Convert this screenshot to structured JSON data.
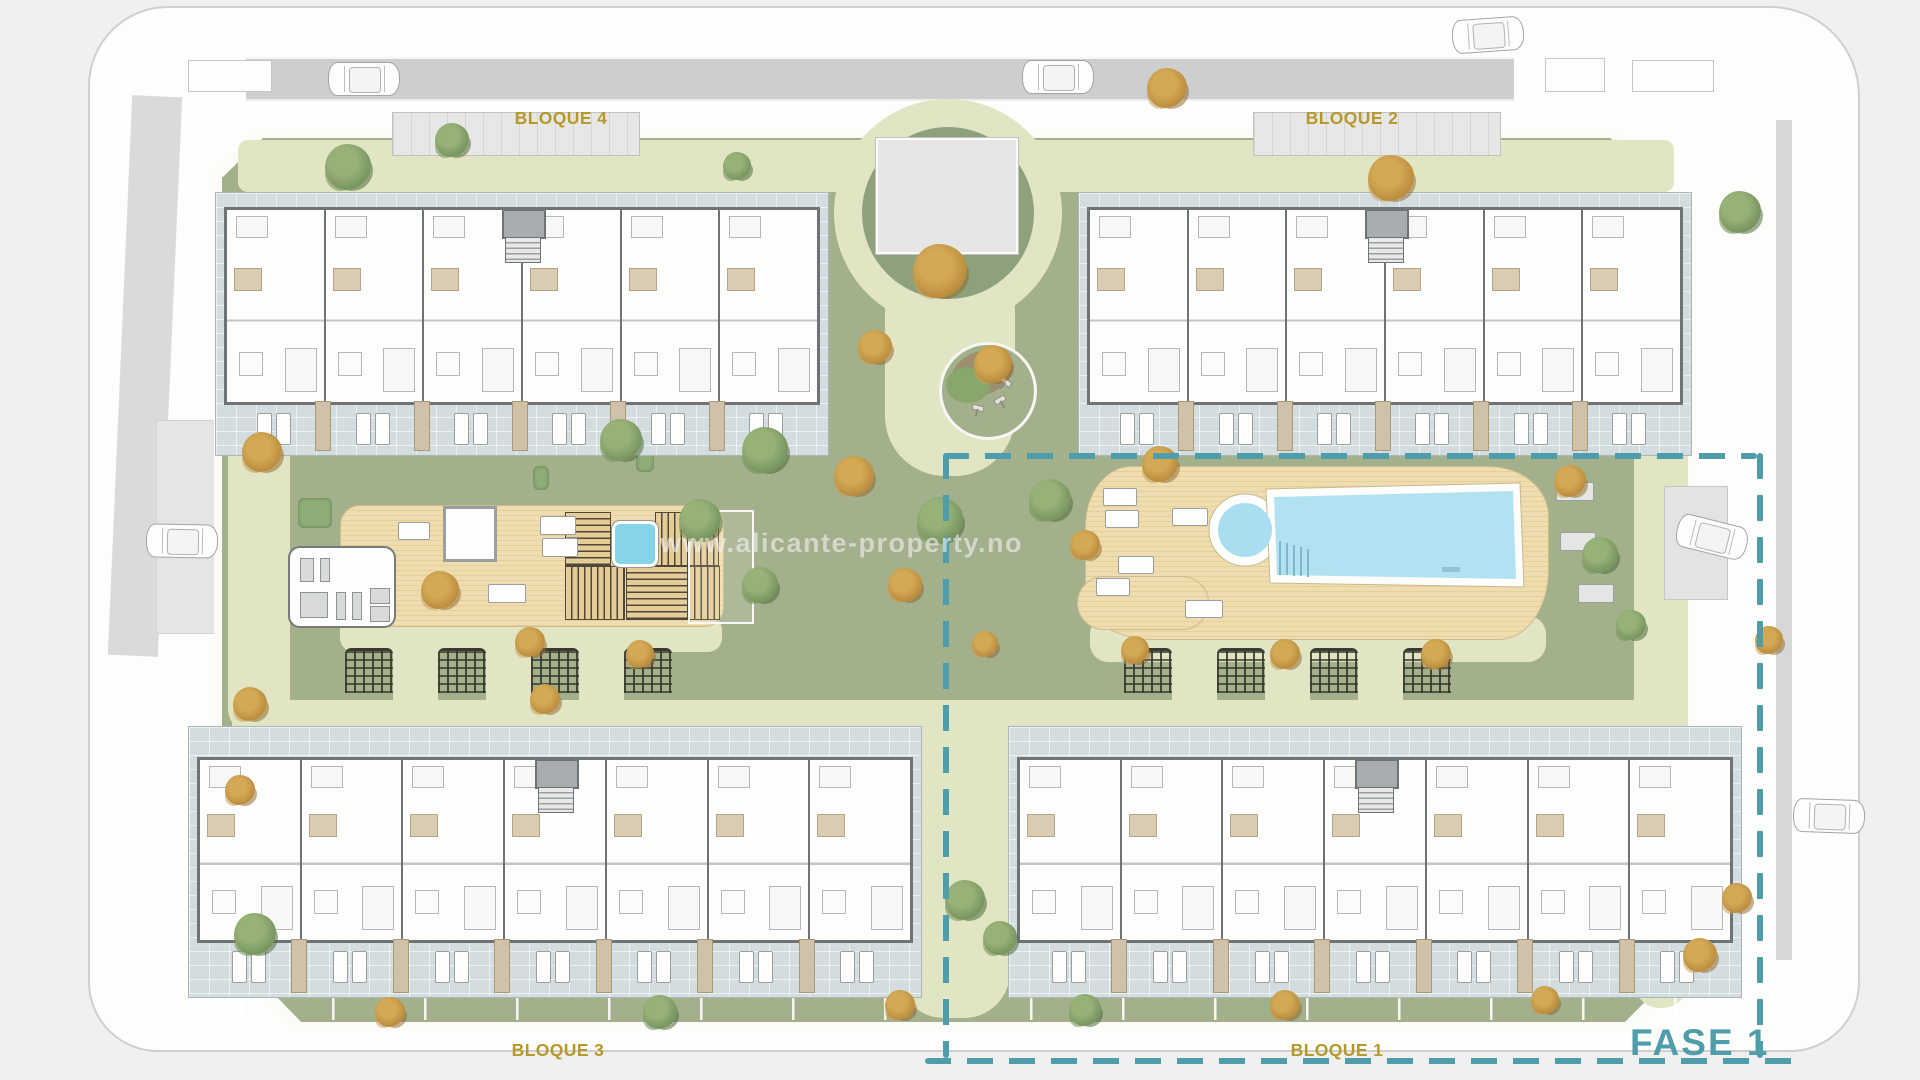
{
  "title": "Residential site plan",
  "labels": {
    "bloque1": "BLOQUE 1",
    "bloque2": "BLOQUE 2",
    "bloque3": "BLOQUE 3",
    "bloque4": "BLOQUE 4",
    "phase": "FASE 1",
    "watermark": "www.alicante-property.no"
  },
  "colors": {
    "site_green": "#a3b08c",
    "path_pale": "#e1e5c4",
    "road_gray": "#cdcfce",
    "terrace_tile": "#d3dddf",
    "wall_dark": "#6e7375",
    "deck_tan": "#efddb0",
    "pool_blue": "#b2e2f2",
    "phase_teal": "#4f9dab",
    "label_gold": "#b5992d",
    "tree_green": "#789560",
    "tree_orange": "#bb8c3e"
  },
  "phase_boundary": {
    "x": 943,
    "y": 453,
    "w": 814,
    "h": 605
  },
  "buildings": [
    {
      "id": "bloque-4",
      "x": 215,
      "y": 192,
      "w": 612,
      "h": 262,
      "units": 6,
      "body_top": 14,
      "body_h": 192
    },
    {
      "id": "bloque-2",
      "x": 1078,
      "y": 192,
      "w": 612,
      "h": 262,
      "units": 6,
      "body_top": 14,
      "body_h": 192
    },
    {
      "id": "bloque-3",
      "x": 188,
      "y": 726,
      "w": 732,
      "h": 270,
      "units": 7,
      "body_top": 30,
      "body_h": 180
    },
    {
      "id": "bloque-1",
      "x": 1008,
      "y": 726,
      "w": 732,
      "h": 270,
      "units": 7,
      "body_top": 30,
      "body_h": 180
    }
  ],
  "roof_tabs": [
    {
      "x": 392,
      "y": 112,
      "w": 246,
      "h": 42
    },
    {
      "x": 1253,
      "y": 112,
      "w": 246,
      "h": 42
    }
  ],
  "paths": [
    {
      "x": 238,
      "y": 140,
      "w": 1436,
      "h": 52,
      "r": 10
    },
    {
      "x": 232,
      "y": 700,
      "w": 1452,
      "h": 48,
      "r": 14
    },
    {
      "x": 885,
      "y": 252,
      "w": 130,
      "h": 224,
      "r": 60
    },
    {
      "x": 898,
      "y": 700,
      "w": 112,
      "h": 318,
      "r": 46
    },
    {
      "x": 228,
      "y": 392,
      "w": 62,
      "h": 344,
      "r": 28
    },
    {
      "x": 1634,
      "y": 428,
      "w": 54,
      "h": 580,
      "r": 26
    },
    {
      "x": 1090,
      "y": 616,
      "w": 456,
      "h": 46,
      "r": 18
    },
    {
      "x": 340,
      "y": 616,
      "w": 382,
      "h": 36,
      "r": 14
    }
  ],
  "path_gaps": [
    {
      "x": 393,
      "y": 620,
      "w": 45,
      "h": 126
    },
    {
      "x": 486,
      "y": 620,
      "w": 45,
      "h": 126
    },
    {
      "x": 579,
      "y": 620,
      "w": 45,
      "h": 126
    },
    {
      "x": 1172,
      "y": 620,
      "w": 45,
      "h": 126
    },
    {
      "x": 1265,
      "y": 620,
      "w": 45,
      "h": 126
    },
    {
      "x": 1358,
      "y": 620,
      "w": 45,
      "h": 126
    }
  ],
  "pergolas": [
    {
      "x": 345,
      "y": 648
    },
    {
      "x": 438,
      "y": 648
    },
    {
      "x": 531,
      "y": 648
    },
    {
      "x": 624,
      "y": 648
    },
    {
      "x": 1124,
      "y": 648
    },
    {
      "x": 1217,
      "y": 648
    },
    {
      "x": 1310,
      "y": 648
    },
    {
      "x": 1403,
      "y": 648
    }
  ],
  "pergola_size": {
    "w": 48,
    "h": 42
  },
  "plaza": {
    "cx": 948,
    "cy": 213,
    "r_outer": 114,
    "r_inner": 86,
    "pad": {
      "x": 876,
      "y": 138,
      "w": 138,
      "h": 112
    }
  },
  "playground": {
    "cx": 985,
    "cy": 388,
    "r": 46
  },
  "deck_left": {
    "x": 340,
    "y": 505,
    "w": 382,
    "h": 120,
    "gym": {
      "x": 288,
      "y": 546,
      "w": 104,
      "h": 78
    },
    "pergola_sq": {
      "x": 443,
      "y": 506,
      "w": 48,
      "h": 50
    },
    "minipool": {
      "x": 612,
      "y": 521,
      "w": 40,
      "h": 40
    },
    "sauna_tiles": [
      {
        "x": 565,
        "y": 512,
        "w": 44,
        "h": 52,
        "v": false
      },
      {
        "x": 655,
        "y": 512,
        "w": 62,
        "h": 52,
        "v": true
      },
      {
        "x": 565,
        "y": 566,
        "w": 58,
        "h": 52,
        "v": true
      },
      {
        "x": 626,
        "y": 566,
        "w": 60,
        "h": 52,
        "v": false
      },
      {
        "x": 688,
        "y": 566,
        "w": 30,
        "h": 52,
        "v": true
      }
    ],
    "loungers": [
      {
        "x": 540,
        "y": 516,
        "w": 34,
        "h": 17
      },
      {
        "x": 542,
        "y": 538,
        "w": 34,
        "h": 17
      },
      {
        "x": 488,
        "y": 584,
        "w": 36,
        "h": 17
      },
      {
        "x": 398,
        "y": 522,
        "w": 30,
        "h": 16
      }
    ]
  },
  "pool_deck": {
    "x": 1085,
    "y": 466,
    "w": 462,
    "h": 172,
    "loungers": [
      {
        "x": 1103,
        "y": 488,
        "w": 32,
        "h": 16
      },
      {
        "x": 1105,
        "y": 510,
        "w": 32,
        "h": 16
      },
      {
        "x": 1172,
        "y": 508,
        "w": 34,
        "h": 16
      },
      {
        "x": 1118,
        "y": 556,
        "w": 34,
        "h": 16
      },
      {
        "x": 1096,
        "y": 578,
        "w": 32,
        "h": 16
      },
      {
        "x": 1185,
        "y": 600,
        "w": 36,
        "h": 16
      }
    ],
    "green_loungers": [
      {
        "x": 1556,
        "y": 482,
        "w": 36,
        "h": 17
      },
      {
        "x": 1560,
        "y": 532,
        "w": 34,
        "h": 17
      },
      {
        "x": 1578,
        "y": 584,
        "w": 34,
        "h": 17
      },
      {
        "x": 1438,
        "y": 560,
        "w": 30,
        "h": 15
      }
    ]
  },
  "laybys": [
    {
      "x": 188,
      "y": 60,
      "w": 82,
      "h": 30,
      "fill": "white"
    },
    {
      "x": 1545,
      "y": 58,
      "w": 58,
      "h": 32,
      "fill": "white"
    },
    {
      "x": 1632,
      "y": 60,
      "w": 80,
      "h": 30,
      "fill": "white"
    },
    {
      "x": 1664,
      "y": 486,
      "w": 62,
      "h": 112,
      "fill": "gray"
    }
  ],
  "cars": [
    {
      "x": 328,
      "y": 62,
      "rot": 0
    },
    {
      "x": 1022,
      "y": 60,
      "rot": 0
    },
    {
      "x": 1452,
      "y": 18,
      "rot": -4
    },
    {
      "x": 146,
      "y": 524,
      "rot": 1
    },
    {
      "x": 1676,
      "y": 520,
      "rot": 14
    },
    {
      "x": 1793,
      "y": 799,
      "rot": 2
    }
  ],
  "car_size": {
    "w": 70,
    "h": 32
  },
  "trees": [
    {
      "x": 348,
      "y": 167,
      "s": 46,
      "c": "g"
    },
    {
      "x": 452,
      "y": 140,
      "s": 34,
      "c": "g"
    },
    {
      "x": 737,
      "y": 166,
      "s": 28,
      "c": "g"
    },
    {
      "x": 940,
      "y": 271,
      "s": 54,
      "c": "o"
    },
    {
      "x": 875,
      "y": 347,
      "s": 34,
      "c": "o"
    },
    {
      "x": 993,
      "y": 364,
      "s": 38,
      "c": "o"
    },
    {
      "x": 1167,
      "y": 88,
      "s": 40,
      "c": "o"
    },
    {
      "x": 1391,
      "y": 178,
      "s": 46,
      "c": "o"
    },
    {
      "x": 1740,
      "y": 212,
      "s": 42,
      "c": "g"
    },
    {
      "x": 262,
      "y": 452,
      "s": 40,
      "c": "o"
    },
    {
      "x": 440,
      "y": 590,
      "s": 38,
      "c": "o"
    },
    {
      "x": 530,
      "y": 642,
      "s": 30,
      "c": "o"
    },
    {
      "x": 621,
      "y": 440,
      "s": 42,
      "c": "g"
    },
    {
      "x": 765,
      "y": 450,
      "s": 46,
      "c": "g"
    },
    {
      "x": 700,
      "y": 520,
      "s": 42,
      "c": "g"
    },
    {
      "x": 760,
      "y": 585,
      "s": 36,
      "c": "g"
    },
    {
      "x": 854,
      "y": 476,
      "s": 40,
      "c": "o"
    },
    {
      "x": 940,
      "y": 520,
      "s": 46,
      "c": "g"
    },
    {
      "x": 905,
      "y": 585,
      "s": 34,
      "c": "o"
    },
    {
      "x": 1050,
      "y": 500,
      "s": 42,
      "c": "g"
    },
    {
      "x": 1085,
      "y": 545,
      "s": 30,
      "c": "o"
    },
    {
      "x": 1160,
      "y": 464,
      "s": 36,
      "c": "o"
    },
    {
      "x": 1570,
      "y": 481,
      "s": 32,
      "c": "o"
    },
    {
      "x": 1600,
      "y": 555,
      "s": 36,
      "c": "g"
    },
    {
      "x": 1631,
      "y": 625,
      "s": 30,
      "c": "g"
    },
    {
      "x": 1436,
      "y": 654,
      "s": 30,
      "c": "o"
    },
    {
      "x": 1285,
      "y": 654,
      "s": 30,
      "c": "o"
    },
    {
      "x": 1135,
      "y": 650,
      "s": 28,
      "c": "o"
    },
    {
      "x": 985,
      "y": 644,
      "s": 26,
      "c": "o"
    },
    {
      "x": 545,
      "y": 699,
      "s": 30,
      "c": "o"
    },
    {
      "x": 640,
      "y": 654,
      "s": 28,
      "c": "o"
    },
    {
      "x": 250,
      "y": 704,
      "s": 34,
      "c": "o"
    },
    {
      "x": 240,
      "y": 790,
      "s": 30,
      "c": "o"
    },
    {
      "x": 255,
      "y": 934,
      "s": 42,
      "c": "g"
    },
    {
      "x": 390,
      "y": 1012,
      "s": 30,
      "c": "o"
    },
    {
      "x": 660,
      "y": 1012,
      "s": 34,
      "c": "g"
    },
    {
      "x": 900,
      "y": 1005,
      "s": 30,
      "c": "o"
    },
    {
      "x": 965,
      "y": 900,
      "s": 40,
      "c": "g"
    },
    {
      "x": 1000,
      "y": 938,
      "s": 34,
      "c": "g"
    },
    {
      "x": 1085,
      "y": 1010,
      "s": 32,
      "c": "g"
    },
    {
      "x": 1285,
      "y": 1005,
      "s": 30,
      "c": "o"
    },
    {
      "x": 1545,
      "y": 1000,
      "s": 28,
      "c": "o"
    },
    {
      "x": 1700,
      "y": 955,
      "s": 34,
      "c": "o"
    },
    {
      "x": 1737,
      "y": 898,
      "s": 30,
      "c": "o"
    },
    {
      "x": 1769,
      "y": 640,
      "s": 28,
      "c": "o"
    }
  ],
  "bushes": [
    {
      "x": 645,
      "y": 396,
      "w": 20,
      "h": 36
    },
    {
      "x": 636,
      "y": 446,
      "w": 18,
      "h": 26
    },
    {
      "x": 533,
      "y": 466,
      "w": 16,
      "h": 24
    },
    {
      "x": 298,
      "y": 498,
      "w": 34,
      "h": 30
    }
  ],
  "fences": [
    {
      "x": 240,
      "y": 978,
      "w": 660,
      "h": 42
    },
    {
      "x": 1030,
      "y": 978,
      "w": 650,
      "h": 42
    }
  ]
}
